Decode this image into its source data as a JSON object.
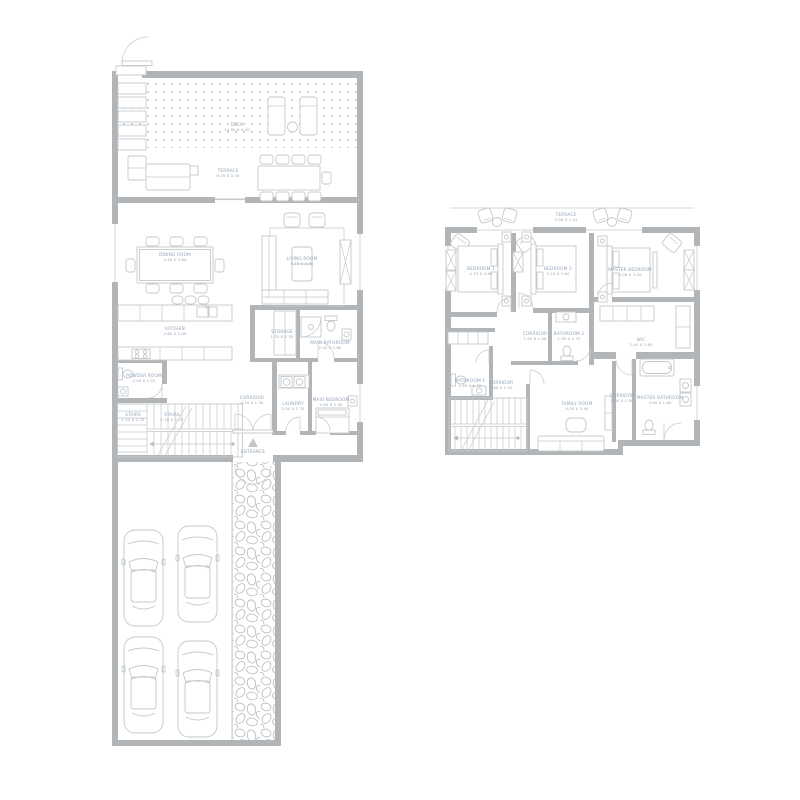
{
  "colors": {
    "bg": "#ffffff",
    "wall": "#b2b5b7",
    "furn": "#c4c8ca",
    "label": "#94a3b5",
    "hatch": "#c9c9c9",
    "pebble": "#b5b9bb"
  },
  "ground_floor": {
    "rooms": {
      "deck": {
        "name": "DECK",
        "dims": "14.90 X 4.40"
      },
      "outdoor": {
        "name": "TERRACE",
        "dims": "6.70 X 3.40"
      },
      "dining": {
        "name": "DINING ROOM",
        "dims": "5.40 X 3.60"
      },
      "living": {
        "name": "LIVING ROOM",
        "dims": "5.10 X 4.80"
      },
      "kitchen": {
        "name": "KITCHEN",
        "dims": "4.80 X 3.00"
      },
      "storage": {
        "name": "STORAGE",
        "dims": "1.70 X 1.50"
      },
      "maid_bathroom": {
        "name": "MAID BATHROOM",
        "dims": "2.00 X 1.60"
      },
      "corridor": {
        "name": "CORRIDOR",
        "dims": "4.20 X 1.30"
      },
      "laundry": {
        "name": "LAUNDRY",
        "dims": "2.00 X 1.70"
      },
      "maid_bedroom": {
        "name": "MAID BEDROOM",
        "dims": "2.60 X 2.30"
      },
      "powder_room": {
        "name": "POWDER ROOM",
        "dims": "2.00 X 1.55"
      },
      "stairs_up": {
        "name": "STAIRS",
        "dims": "1.20 X 2.70"
      },
      "stairs_dn": {
        "name": "STAIRS",
        "dims": "1.20 X 2.70"
      },
      "entrance": {
        "name": "ENTRANCE"
      }
    }
  },
  "first_floor": {
    "rooms": {
      "terrace": {
        "name": "TERRACE",
        "dims": "5.06 X 1.24"
      },
      "bedroom_1": {
        "name": "BEDROOM 1",
        "dims": "4.10 X 3.60"
      },
      "bedroom_2": {
        "name": "BEDROOM 2",
        "dims": "4.10 X 3.60"
      },
      "master_bedroom": {
        "name": "MASTER BEDROOM",
        "dims": "4.00 X 3.20"
      },
      "wic": {
        "name": "WIC",
        "dims": "2.40 X 1.60"
      },
      "corridor_mid": {
        "name": "CORRIDOR",
        "dims": "1.95 X 1.06"
      },
      "bathroom_2": {
        "name": "BATHROOM 2",
        "dims": "1.95 X 1.70"
      },
      "bathroom_1": {
        "name": "BATHROOM 1",
        "dims": "1.80 X 1.70"
      },
      "corridor_left": {
        "name": "CORRIDOR",
        "dims": "1.80 X 1.20"
      },
      "family_room": {
        "name": "FAMILY ROOM",
        "dims": "4.00 X 3.40"
      },
      "corridor_right": {
        "name": "CORRIDOR",
        "dims": "1.90 X 1.06"
      },
      "master_bathroom": {
        "name": "MASTER BATHROOM",
        "dims": "3.00 X 1.60"
      }
    }
  }
}
